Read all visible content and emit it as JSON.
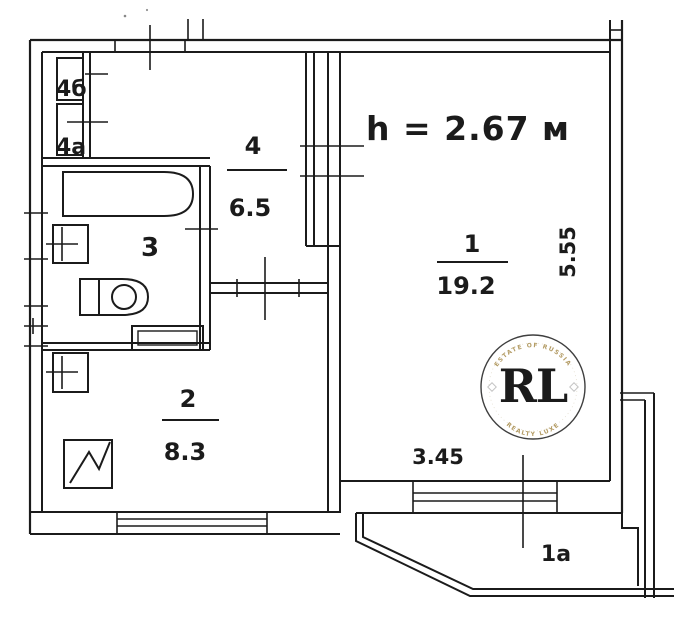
{
  "plan": {
    "title": "apartment-floor-plan",
    "height_note": "h = 2.67 м",
    "rooms": [
      {
        "number": "1",
        "area": "19.2"
      },
      {
        "number": "2",
        "area": "8.3"
      },
      {
        "number": "3",
        "area": ""
      },
      {
        "number": "4",
        "area": "6.5"
      }
    ]
  },
  "labels": {
    "room1_number": "1",
    "room1_area": "19.2",
    "room2_number": "2",
    "room2_area": "8.3",
    "room3_number": "3",
    "room4_number": "4",
    "room4_area": "6.5",
    "closet_b": "4б",
    "closet_a": "4a",
    "balcony": "1a",
    "dim_room1_depth": "5.55",
    "dim_room1_width": "3.45",
    "height_note": "h = 2.67 м"
  },
  "watermark": {
    "initials": "RL",
    "arc_top": "ESTATE OF RUSSIA",
    "arc_bottom": "REALTY LUXE"
  },
  "colors": {
    "ink": "#1b1b1b",
    "height_note_blue": "#2e6eb5",
    "watermark_gold": "#c2a14b"
  }
}
